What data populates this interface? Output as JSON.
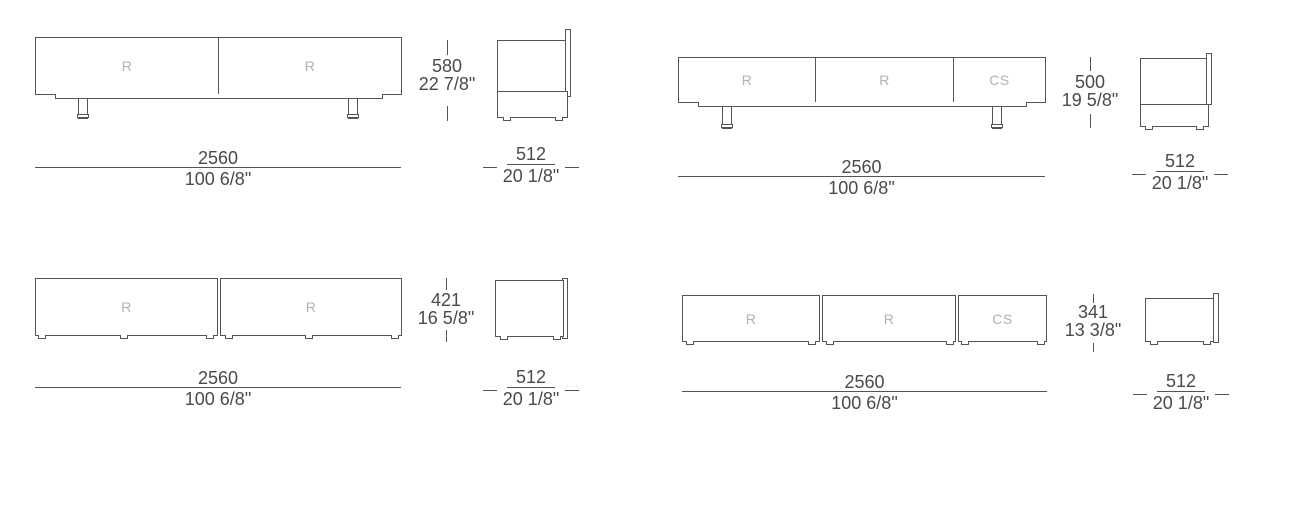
{
  "colors": {
    "line": "#545454",
    "dimension_text": "#4a4a4a",
    "module_label": "#b2b2b2"
  },
  "units": [
    {
      "id": "top-left",
      "compartments": [
        "R",
        "R"
      ],
      "width_mm": "2560",
      "width_in": "100 6/8\"",
      "height_mm": "580",
      "height_in": "22 7/8\"",
      "depth_mm": "512",
      "depth_in": "20 1/8\""
    },
    {
      "id": "top-right",
      "compartments": [
        "R",
        "R",
        "CS"
      ],
      "width_mm": "2560",
      "width_in": "100 6/8\"",
      "height_mm": "500",
      "height_in": "19 5/8\"",
      "depth_mm": "512",
      "depth_in": "20 1/8\""
    },
    {
      "id": "bottom-left",
      "compartments": [
        "R",
        "R"
      ],
      "width_mm": "2560",
      "width_in": "100 6/8\"",
      "height_mm": "421",
      "height_in": "16 5/8\"",
      "depth_mm": "512",
      "depth_in": "20 1/8\""
    },
    {
      "id": "bottom-right",
      "compartments": [
        "R",
        "R",
        "CS"
      ],
      "width_mm": "2560",
      "width_in": "100 6/8\"",
      "height_mm": "341",
      "height_in": "13 3/8\"",
      "depth_mm": "512",
      "depth_in": "20 1/8\""
    }
  ]
}
